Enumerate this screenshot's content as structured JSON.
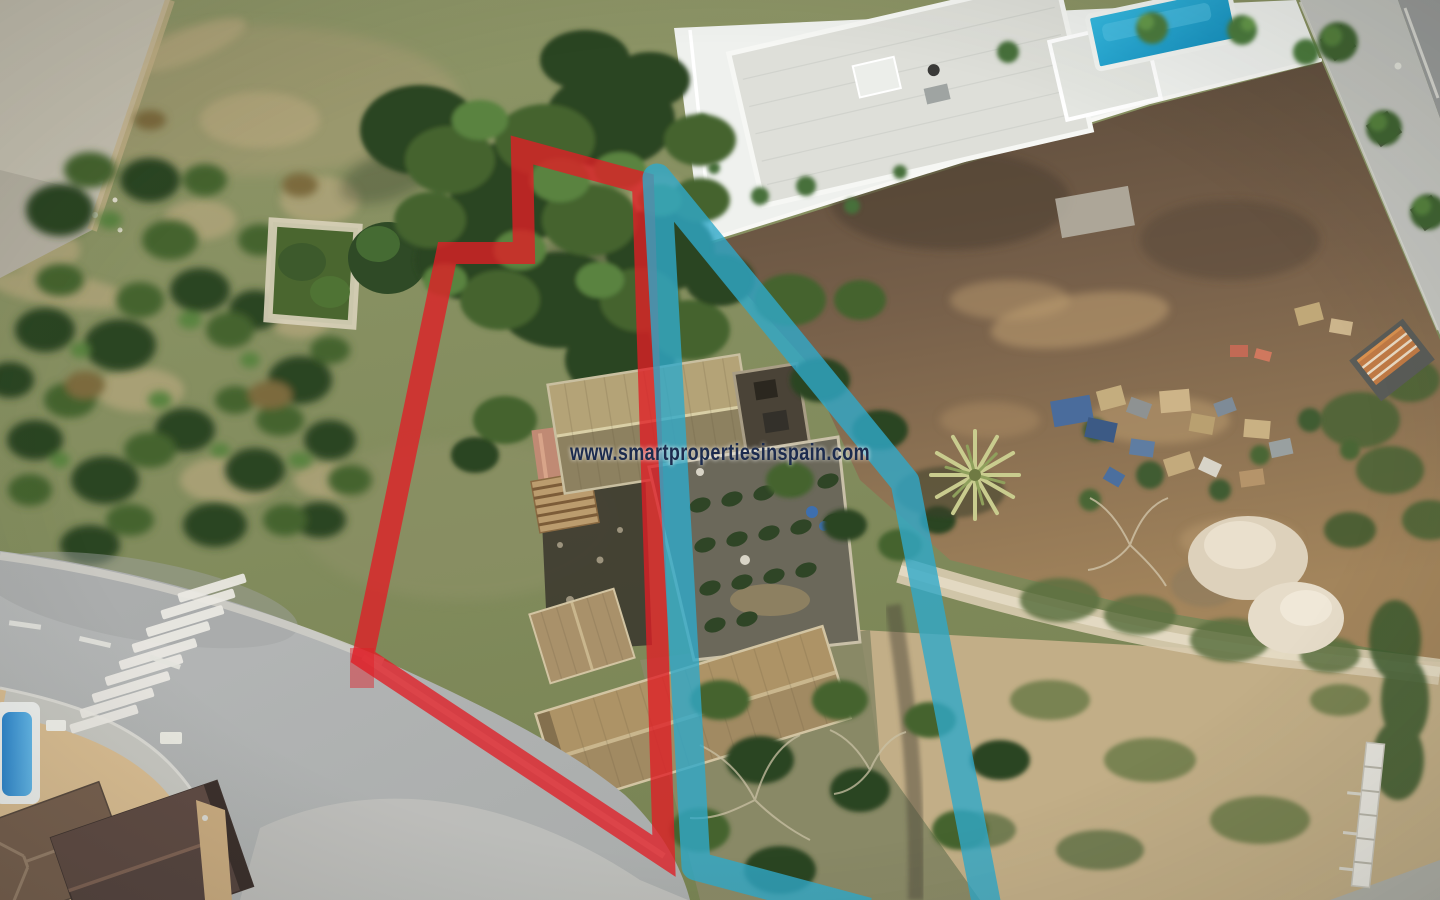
{
  "image": {
    "kind": "aerial drone photograph",
    "subject": "rural building plot with farmhouse ruin, neighbouring modern villa with pool, curved road with zebra crossing",
    "watermark": {
      "text": "www.smartpropertiesinspain.com",
      "color": "#1c2b4e",
      "halo_color": "#ffffff"
    }
  },
  "overlays": {
    "red_boundary": {
      "name": "red plot boundary outline",
      "color": "#e01d25",
      "opacity": 0.78,
      "points": "522,150 643,183 664,856 363,657 447,253 524,253"
    },
    "blue_boundary": {
      "name": "blue plot boundary outline",
      "color": "#2fa9c9",
      "opacity": 0.8,
      "points": "868,912 696,866 657,178 905,482 988,912"
    }
  },
  "scene": {
    "villa": {
      "label": "modern white villa",
      "roof_color": "#dedfd9",
      "pool_color": "#2ab0d8"
    },
    "ruin": {
      "label": "old farmhouse ruin with tiled roofs",
      "upper_roof_color": "#b4a377",
      "lower_roof_color": "#a18a62"
    },
    "road": {
      "label": "asphalt road with zebra crossing",
      "color": "#b4b6b6",
      "crosswalk_stripe_count": 9
    },
    "terrain": {
      "scrub_color": "#879062",
      "dirt_color": "#7c6148",
      "pale_dirt_color": "#c2ae87"
    },
    "small_pool_color": "#3f9ad8",
    "palm_tree_color": "#c9cc8e"
  }
}
